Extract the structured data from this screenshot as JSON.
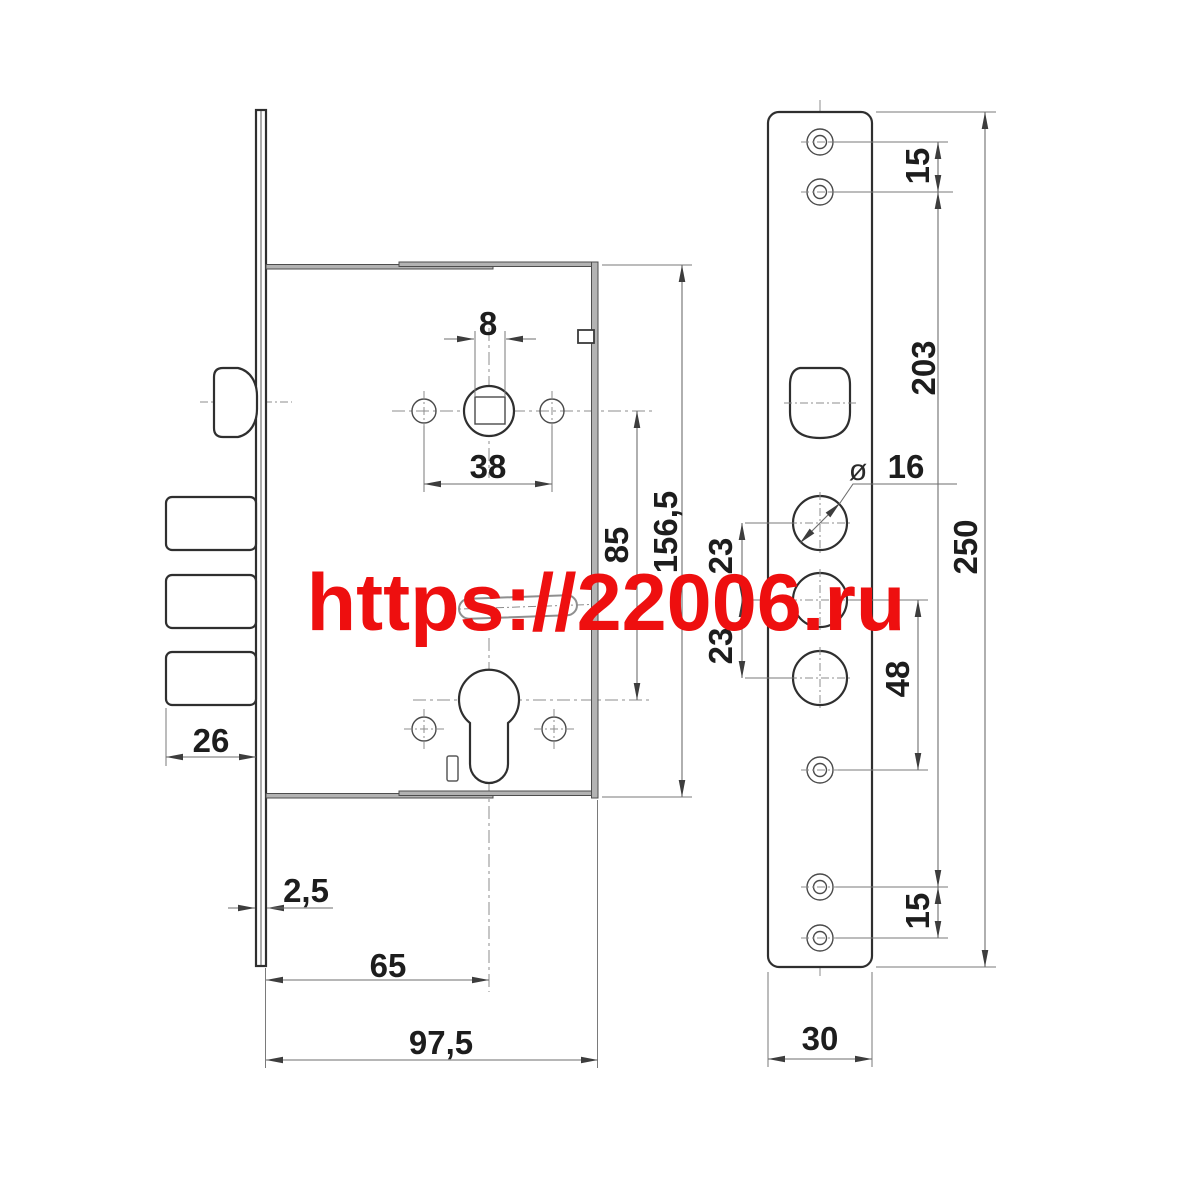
{
  "title": "mortise-lock-technical-drawing",
  "watermark": {
    "text": "https://22006.ru",
    "color": "#ee0f0f"
  },
  "colors": {
    "outline": "#2f2f2f",
    "dimension_lines": "#6e6e6e",
    "thick_edge": "#b3b3b3"
  },
  "side_view": {
    "dims": {
      "spindle_square": "8",
      "handle_hole_span": "38",
      "bolt_protrusion": "26",
      "faceplate_thickness": "2,5",
      "backset": "65",
      "body_depth": "97,5",
      "hub_to_cylinder": "85",
      "body_height": "156,5"
    }
  },
  "front_view": {
    "dims": {
      "screw_spacing_top": "15",
      "screw_span": "203",
      "diameter_symbol": "ø",
      "hole_diameter": "16",
      "hole_gap_upper": "23",
      "hole_gap_lower": "23",
      "cylinder_to_screw": "48",
      "plate_length": "250",
      "screw_spacing_bottom": "15",
      "plate_width": "30"
    }
  }
}
